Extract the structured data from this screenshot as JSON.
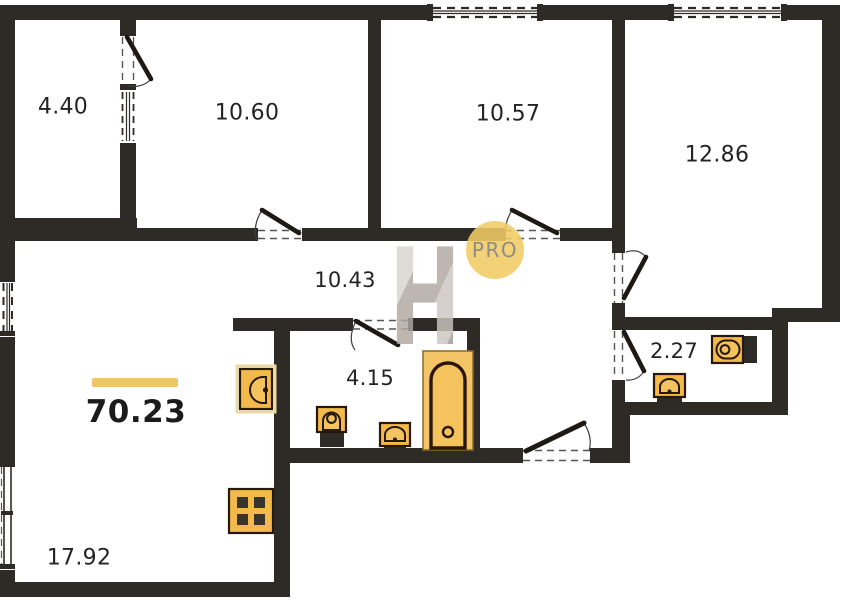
{
  "plan": {
    "total_area": "70.23",
    "rooms": [
      {
        "name": "loggia",
        "area": "4.40"
      },
      {
        "name": "bedroom-1",
        "area": "10.60"
      },
      {
        "name": "bedroom-2",
        "area": "10.57"
      },
      {
        "name": "bedroom-3",
        "area": "12.86"
      },
      {
        "name": "hallway",
        "area": "10.43"
      },
      {
        "name": "bathroom",
        "area": "4.15"
      },
      {
        "name": "wc",
        "area": "2.27"
      },
      {
        "name": "living-room",
        "area": "17.92"
      }
    ],
    "badge": {
      "label": "PRO"
    },
    "watermark": {
      "letter": "H"
    },
    "icons": [
      "kitchen-sink-icon",
      "stove-icon",
      "toilet-icon",
      "washbasin-icon",
      "bathtub-icon",
      "wc-washbasin-icon",
      "wc-toilet-icon"
    ],
    "colors": {
      "wall": "#2e2b27",
      "fixture_fill": "#f3ba4b",
      "accent_line": "#f0c46a",
      "badge_bg": "#f1cc68",
      "watermark_gray": "#bdb5ae"
    }
  }
}
